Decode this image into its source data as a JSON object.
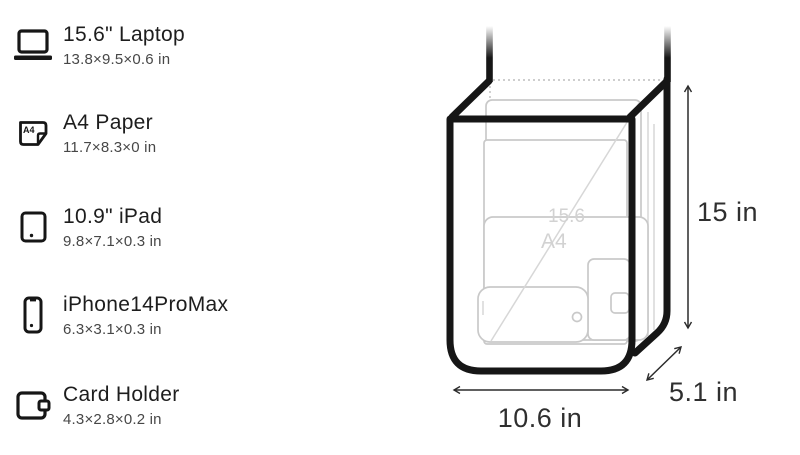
{
  "items": [
    {
      "name": "15.6\" Laptop",
      "dims": "13.8×9.5×0.6 in",
      "icon": "laptop-icon"
    },
    {
      "name": "A4 Paper",
      "dims": "11.7×8.3×0 in",
      "icon": "a4-paper-icon",
      "icon_label": "A4"
    },
    {
      "name": "10.9\" iPad",
      "dims": "9.8×7.1×0.3 in",
      "icon": "tablet-icon"
    },
    {
      "name": "iPhone14ProMax",
      "dims": "6.3×3.1×0.3 in",
      "icon": "smartphone-icon"
    },
    {
      "name": "Card Holder",
      "dims": "4.3×2.8×0.2 in",
      "icon": "wallet-icon"
    }
  ],
  "bag": {
    "height_label": "15 in",
    "width_label": "10.6 in",
    "depth_label": "5.1 in",
    "inner_labels": {
      "laptop_diagonal": "15.6",
      "a4_sheet": "A4"
    }
  },
  "colors": {
    "outline_black": "#161616",
    "ghost_gray": "#c9c9c9",
    "dimension_text": "#2f2f2f",
    "title_text": "#1d1d1d",
    "subtitle_text": "#474747"
  }
}
